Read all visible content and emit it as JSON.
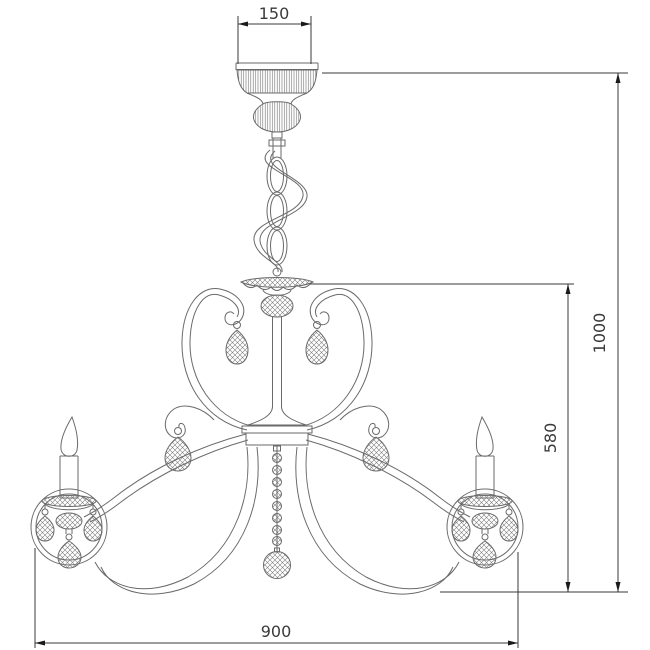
{
  "drawing": {
    "type": "technical-dimension-drawing",
    "subject": "chandelier",
    "background": "#ffffff",
    "art_line_color": "#6a6a6a",
    "dimension_line_color": "#3a3a3a",
    "dimensions": {
      "canopy_width": "150",
      "overall_height": "1000",
      "body_height": "580",
      "body_width": "900"
    }
  }
}
